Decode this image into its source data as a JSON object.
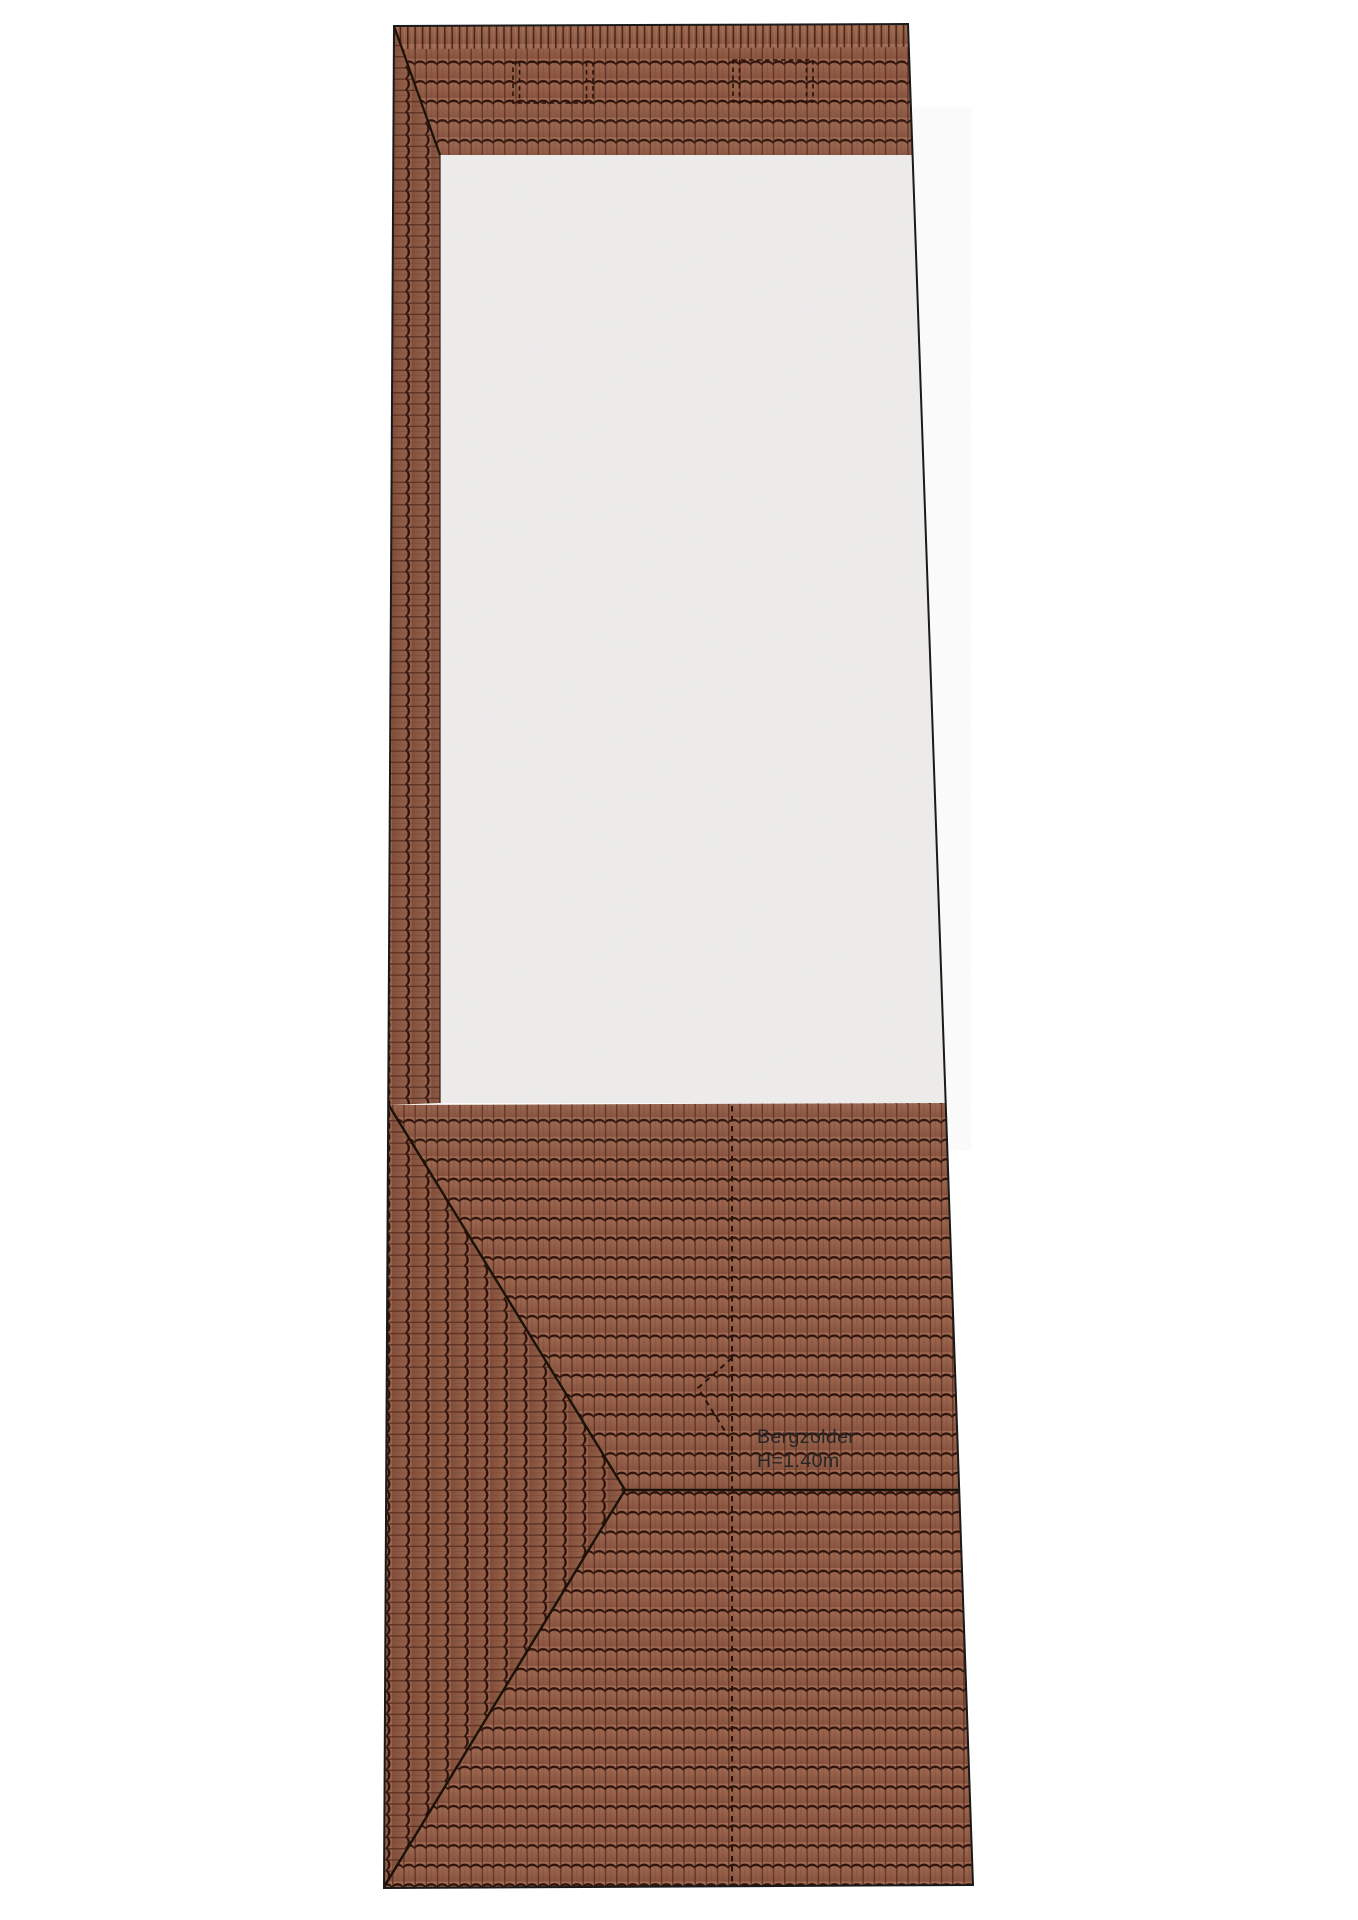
{
  "labels": {
    "area_name": "Bergzolder",
    "height_note": "H=1.40m"
  },
  "colors": {
    "background": "#ffffff",
    "tile_body": "#956049",
    "tile_body_light": "#a26c55",
    "tile_body_dark": "#88533f",
    "tile_scallop": "#2e130b",
    "tile_joint": "#5a2f22",
    "flat_area": "#f0efee",
    "outline": "#1a1a1a",
    "dashed_line": "#2a1208",
    "label_text": "#262626"
  }
}
